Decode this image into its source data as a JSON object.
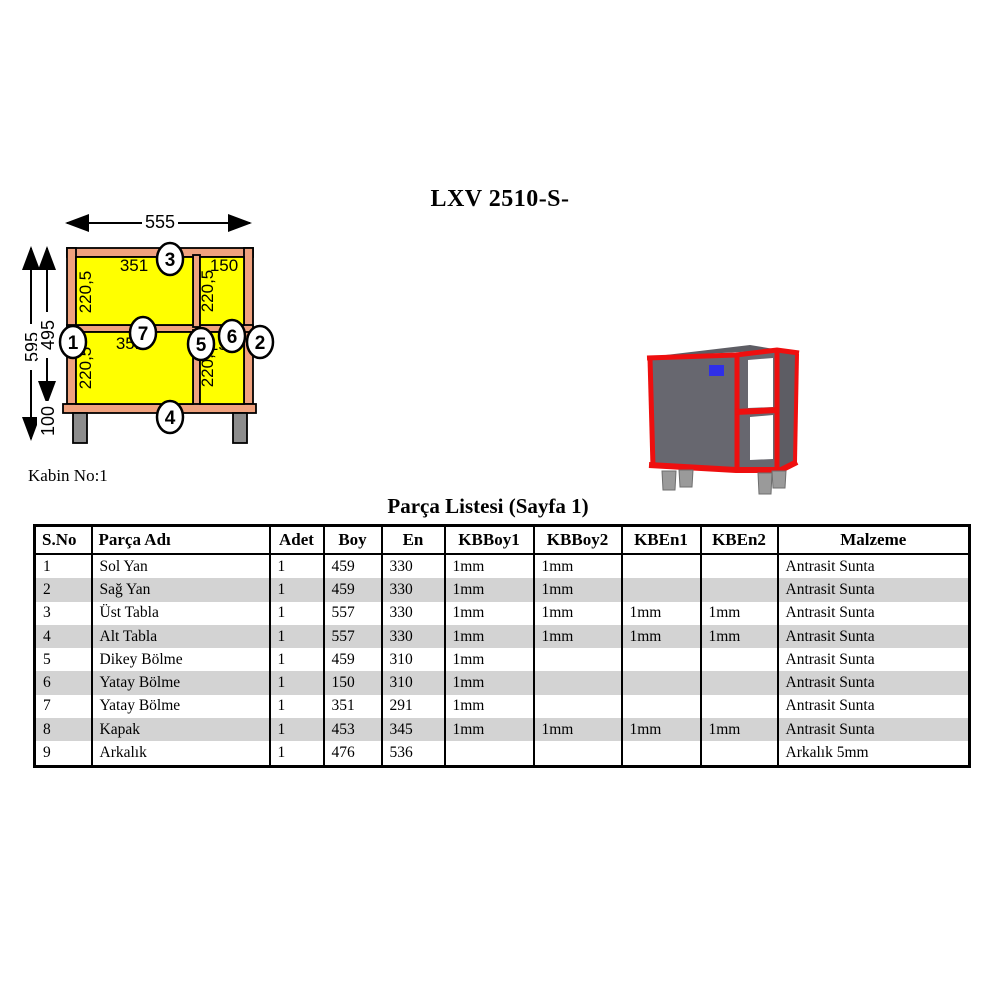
{
  "page": {
    "title": "LXV 2510-S-",
    "cabin_label": "Kabin No:1"
  },
  "drawing": {
    "dims": {
      "width": "555",
      "total_height": "595",
      "body_height": "495",
      "leg_height": "100"
    },
    "compartments": {
      "top_left": {
        "width": "351",
        "height": "220,5"
      },
      "top_right": {
        "width": "150",
        "height": "220,5"
      },
      "bottom_left": {
        "width": "351",
        "height": "220,5"
      },
      "bottom_right": {
        "width": "150",
        "height": "220,5"
      }
    },
    "callouts": [
      "1",
      "2",
      "3",
      "4",
      "5",
      "6",
      "7"
    ],
    "colors": {
      "frame": "#f0a27e",
      "panel": "#ffff00",
      "leg": "#8c8c8c"
    }
  },
  "render3d": {
    "colors": {
      "body": "#67676f",
      "body_dark": "#5d5d64",
      "edge_red": "#ee0f0f",
      "handle_blue": "#2f2fe8",
      "leg": "#9a9a9a"
    }
  },
  "parts_table": {
    "title": "Parça Listesi  (Sayfa 1)",
    "columns": [
      "S.No",
      "Parça Adı",
      "Adet",
      "Boy",
      "En",
      "KBBoy1",
      "KBBoy2",
      "KBEn1",
      "KBEn2",
      "Malzeme"
    ],
    "rows": [
      [
        "1",
        "Sol Yan",
        "1",
        "459",
        "330",
        "1mm",
        "1mm",
        "",
        "",
        "Antrasit Sunta"
      ],
      [
        "2",
        "Sağ Yan",
        "1",
        "459",
        "330",
        "1mm",
        "1mm",
        "",
        "",
        "Antrasit Sunta"
      ],
      [
        "3",
        "Üst Tabla",
        "1",
        "557",
        "330",
        "1mm",
        "1mm",
        "1mm",
        "1mm",
        "Antrasit Sunta"
      ],
      [
        "4",
        "Alt Tabla",
        "1",
        "557",
        "330",
        "1mm",
        "1mm",
        "1mm",
        "1mm",
        "Antrasit Sunta"
      ],
      [
        "5",
        "Dikey Bölme",
        "1",
        "459",
        "310",
        "1mm",
        "",
        "",
        "",
        "Antrasit Sunta"
      ],
      [
        "6",
        "Yatay Bölme",
        "1",
        "150",
        "310",
        "1mm",
        "",
        "",
        "",
        "Antrasit Sunta"
      ],
      [
        "7",
        "Yatay Bölme",
        "1",
        "351",
        "291",
        "1mm",
        "",
        "",
        "",
        "Antrasit Sunta"
      ],
      [
        "8",
        "Kapak",
        "1",
        "453",
        "345",
        "1mm",
        "1mm",
        "1mm",
        "1mm",
        "Antrasit Sunta"
      ],
      [
        "9",
        "Arkalık",
        "1",
        "476",
        "536",
        "",
        "",
        "",
        "",
        "Arkalık 5mm"
      ]
    ],
    "stripe_color": "#d3d3d3"
  }
}
